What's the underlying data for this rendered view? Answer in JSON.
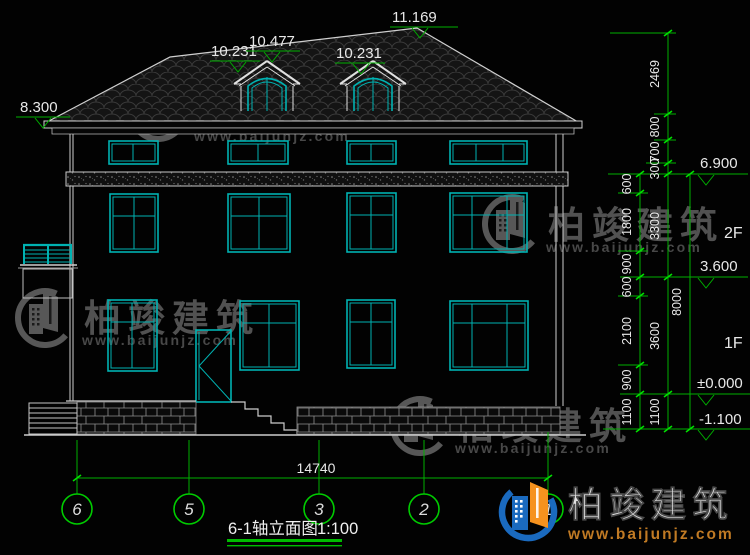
{
  "drawing": {
    "caption": "6-1轴立面图",
    "scale": "1:100",
    "floor_labels": {
      "second": "2F",
      "first": "1F"
    },
    "levels": {
      "ridge": "11.169",
      "dormer_ridge": "10.477",
      "dormer_left": "10.231",
      "dormer_right": "10.231",
      "eave": "8.300",
      "attic_floor": "6.900",
      "second_floor": "3.600",
      "ground": "±0.000",
      "foundation": "-1.100"
    },
    "axes": [
      "6",
      "5",
      "3",
      "2",
      "1"
    ],
    "dims": {
      "total_width": "14740",
      "total_height": "8000",
      "inner_chain": [
        "600",
        "1800",
        "900",
        "600",
        "2100",
        "900",
        "1100"
      ],
      "outer_chain": [
        "2469",
        "800",
        "700",
        "300",
        "3300",
        "3600",
        "1100"
      ]
    }
  },
  "watermark": {
    "name": "柏竣建筑",
    "url": "www.baijunjz.com"
  },
  "logo": {
    "name": "柏竣建筑",
    "url": "www.baijunjz.com"
  },
  "colors": {
    "background": "#020202",
    "cad_green": "#00b000",
    "tick_green": "#00e000",
    "window_cyan": "#00b2b2",
    "line_white": "#d6d6d6",
    "logo_blue": "#1a6abf",
    "logo_orange": "#f6921e"
  }
}
